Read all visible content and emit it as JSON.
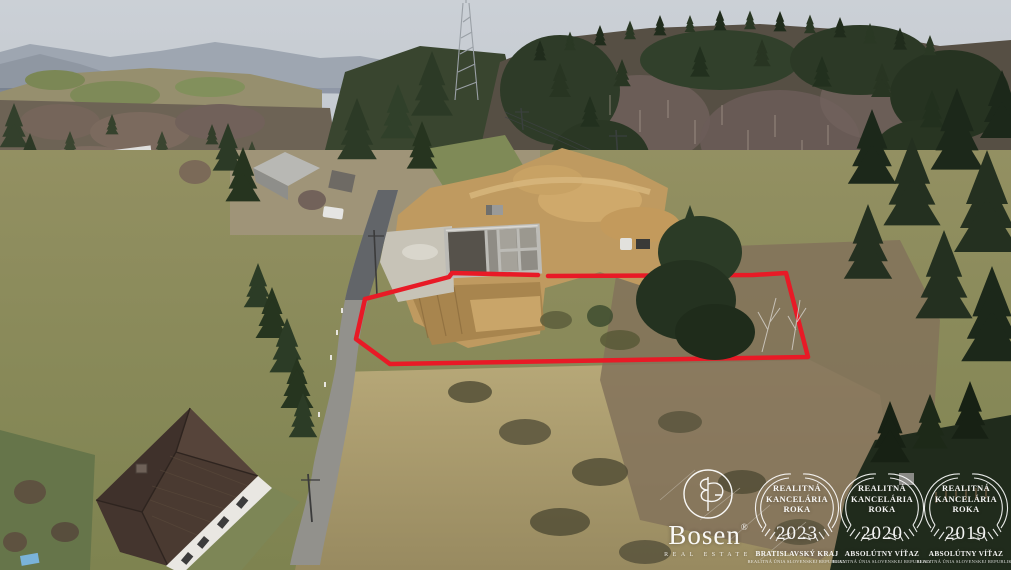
{
  "watermark": {
    "color": "#FFFFFF",
    "logo": {
      "name": "Bosen",
      "registered": "®",
      "tagline": "REAL ESTATE"
    },
    "badges": [
      {
        "title": "REALITNÁ KANCELÁRIA ROKA",
        "year": "2023",
        "award": "BRATISLAVSKÝ KRAJ",
        "org": "REALITNÁ ÚNIA SLOVENSKEJ REPUBLIKY"
      },
      {
        "title": "REALITNÁ KANCELÁRIA ROKA",
        "year": "2020",
        "award": "ABSOLÚTNY VÍŤAZ",
        "org": "REALITNÁ ÚNIA SLOVENSKEJ REPUBLIKY"
      },
      {
        "title": "REALITNÁ KANCELÁRIA ROKA",
        "year": "2019",
        "award": "ABSOLÚTNY VÍŤAZ",
        "org": "REALITNÁ ÚNIA SLOVENSKEJ REPUBLIKY"
      }
    ]
  },
  "annotation": {
    "plot_outline_color": "#E81A26"
  }
}
